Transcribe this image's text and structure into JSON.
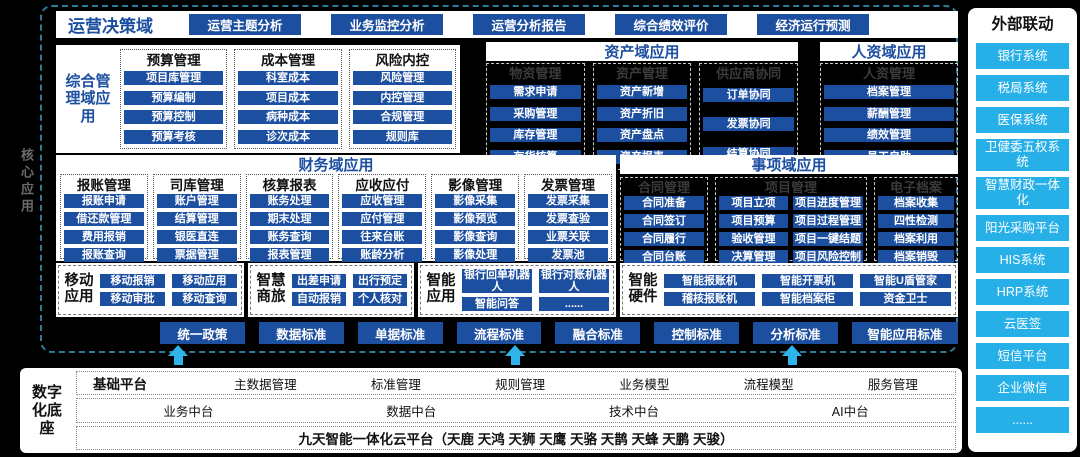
{
  "colors": {
    "primary_blue": "#1d4fa1",
    "cyan_accent": "#27b0e8",
    "border_teal": "#2e7b97",
    "background": "#000000"
  },
  "core_label": "核心应用",
  "decision_domain": {
    "title": "运营决策域",
    "items": [
      "运营主题分析",
      "业务监控分析",
      "运营分析报告",
      "综合绩效评价",
      "经济运行预测"
    ]
  },
  "comprehensive": {
    "title": "综合管理域应用",
    "columns": [
      {
        "header": "预算管理",
        "items": [
          "项目库管理",
          "预算编制",
          "预算控制",
          "预算考核"
        ]
      },
      {
        "header": "成本管理",
        "items": [
          "科室成本",
          "项目成本",
          "病种成本",
          "诊次成本"
        ]
      },
      {
        "header": "风险内控",
        "items": [
          "风险管理",
          "内控管理",
          "合规管理",
          "规则库"
        ]
      }
    ]
  },
  "asset": {
    "title": "资产域应用",
    "columns": [
      {
        "header": "物资管理",
        "items": [
          "需求申请",
          "采购管理",
          "库存管理",
          "存货核算"
        ]
      },
      {
        "header": "资产管理",
        "items": [
          "资产新增",
          "资产折旧",
          "资产盘点",
          "资产报表"
        ]
      },
      {
        "header": "供应商协同",
        "items": [
          "订单协同",
          "发票协同",
          "结算协同"
        ]
      }
    ]
  },
  "hr": {
    "title": "人资域应用",
    "columns": [
      {
        "header": "人资管理",
        "items": [
          "档案管理",
          "薪酬管理",
          "绩效管理",
          "员工自助"
        ]
      }
    ]
  },
  "finance": {
    "title": "财务域应用",
    "columns": [
      {
        "header": "报账管理",
        "items": [
          "报账申请",
          "借还款管理",
          "费用报销",
          "报账查询"
        ]
      },
      {
        "header": "司库管理",
        "items": [
          "账户管理",
          "结算管理",
          "银医直连",
          "票据管理"
        ]
      },
      {
        "header": "核算报表",
        "items": [
          "账务处理",
          "期末处理",
          "账务查询",
          "报表管理"
        ]
      },
      {
        "header": "应收应付",
        "items": [
          "应收管理",
          "应付管理",
          "往来台账",
          "账龄分析"
        ]
      },
      {
        "header": "影像管理",
        "items": [
          "影像采集",
          "影像预览",
          "影像查询",
          "影像处理"
        ]
      },
      {
        "header": "发票管理",
        "items": [
          "发票采集",
          "发票查验",
          "业票关联",
          "发票池"
        ]
      }
    ]
  },
  "matter": {
    "title": "事项域应用",
    "groups": [
      {
        "header": "合同管理",
        "columns": [
          [
            "合同准备",
            "合同签订",
            "合同履行",
            "合同台账"
          ]
        ]
      },
      {
        "header": "项目管理",
        "columns": [
          [
            "项目立项",
            "项目预算",
            "验收管理",
            "决算管理"
          ],
          [
            "项目进度管理",
            "项目过程管理",
            "项目一键结题",
            "项目风险控制"
          ]
        ]
      },
      {
        "header": "电子档案",
        "columns": [
          [
            "档案收集",
            "四性检测",
            "档案利用",
            "档案销毁"
          ]
        ]
      }
    ]
  },
  "bottom_apps": [
    {
      "label": "移动应用",
      "rows": [
        [
          "移动报销",
          "移动应用"
        ],
        [
          "移动审批",
          "移动查询"
        ]
      ]
    },
    {
      "label": "智慧商旅",
      "rows": [
        [
          "出差申请",
          "出行预定"
        ],
        [
          "自动报销",
          "个人核对"
        ]
      ]
    },
    {
      "label": "智能应用",
      "rows": [
        [
          "银行回单机器人",
          "银行对账机器人"
        ],
        [
          "智能问答",
          "......"
        ]
      ]
    },
    {
      "label": "智能硬件",
      "rows": [
        [
          "智能报账机",
          "智能开票机",
          "智能U盾管家"
        ],
        [
          "稽核报账机",
          "智能档案柜",
          "资金卫士"
        ]
      ]
    }
  ],
  "standards": [
    "统一政策",
    "数据标准",
    "单据标准",
    "流程标准",
    "融合标准",
    "控制标准",
    "分析标准",
    "智能应用标准"
  ],
  "foundation": {
    "label": "数字化底座",
    "row1_lead": "基础平台",
    "row1": [
      "主数据管理",
      "标准管理",
      "规则管理",
      "业务模型",
      "流程模型",
      "服务管理"
    ],
    "row2": [
      "业务中台",
      "数据中台",
      "技术中台",
      "AI中台"
    ],
    "row3": "九天智能一体化云平台（天鹿 天鸿 天狮 天鹰 天骆 天鹊 天蜂 天鹏 天骏）"
  },
  "external": {
    "title": "外部联动",
    "items": [
      "银行系统",
      "税局系统",
      "医保系统",
      "卫健委五权系统",
      "智慧财政一体化",
      "阳光采购平台",
      "HIS系统",
      "HRP系统",
      "云医签",
      "短信平台",
      "企业微信",
      "......"
    ]
  }
}
